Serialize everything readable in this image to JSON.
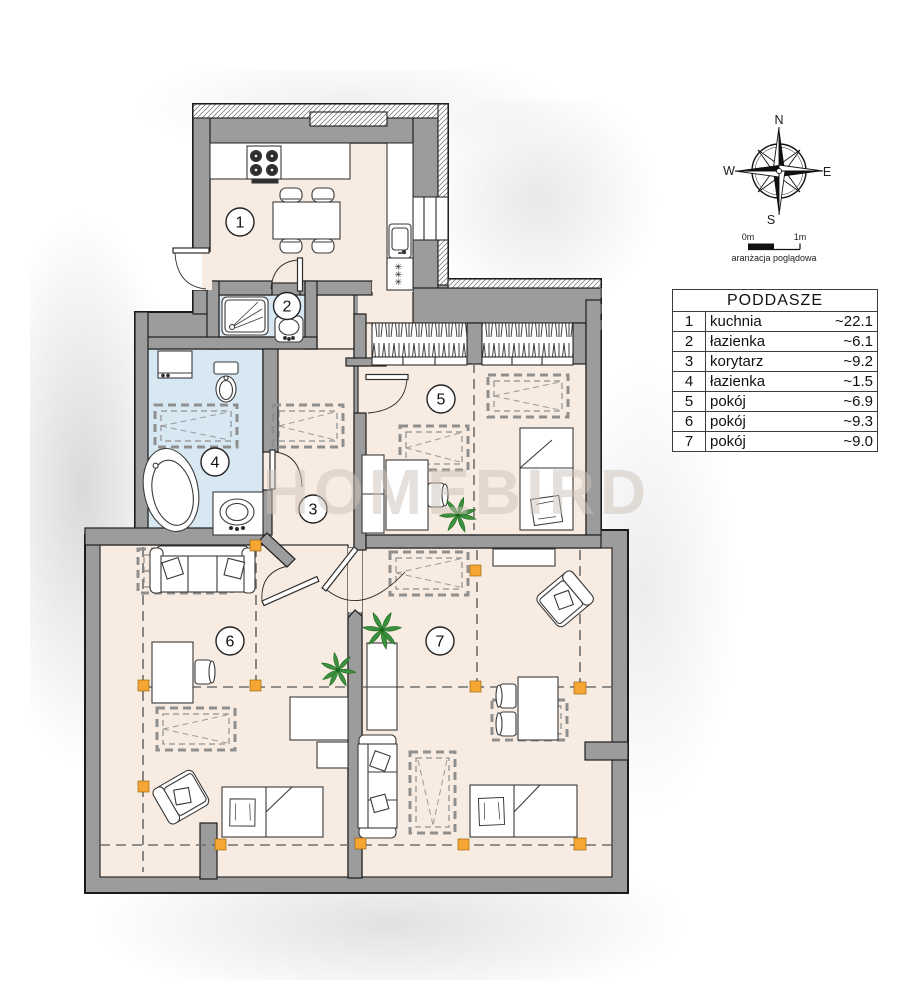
{
  "watermark": "HOMEBIRD",
  "legend": {
    "title": "PODDASZE",
    "rows": [
      {
        "no": "1",
        "name": "kuchnia",
        "area": "~22.1"
      },
      {
        "no": "2",
        "name": "łazienka",
        "area": "~6.1"
      },
      {
        "no": "3",
        "name": "korytarz",
        "area": "~9.2"
      },
      {
        "no": "4",
        "name": "łazienka",
        "area": "~1.5"
      },
      {
        "no": "5",
        "name": "pokój",
        "area": "~6.9"
      },
      {
        "no": "6",
        "name": "pokój",
        "area": "~9.3"
      },
      {
        "no": "7",
        "name": "pokój",
        "area": "~9.0"
      }
    ]
  },
  "compass": {
    "n": "N",
    "e": "E",
    "s": "S",
    "w": "W"
  },
  "scale_bar": {
    "zero": "0m",
    "one": "1m",
    "caption": "aranżacja poglądowa"
  },
  "plan": {
    "fridge_stars": "✳✳✳"
  },
  "colors": {
    "floor": "#f8ebe1",
    "bathroom": "#d7e8f3",
    "wall": "#9c9c9c",
    "post_accent": "#f6a733",
    "dash_line": "#6f6f6f",
    "watermark": "#cfc3ba"
  }
}
